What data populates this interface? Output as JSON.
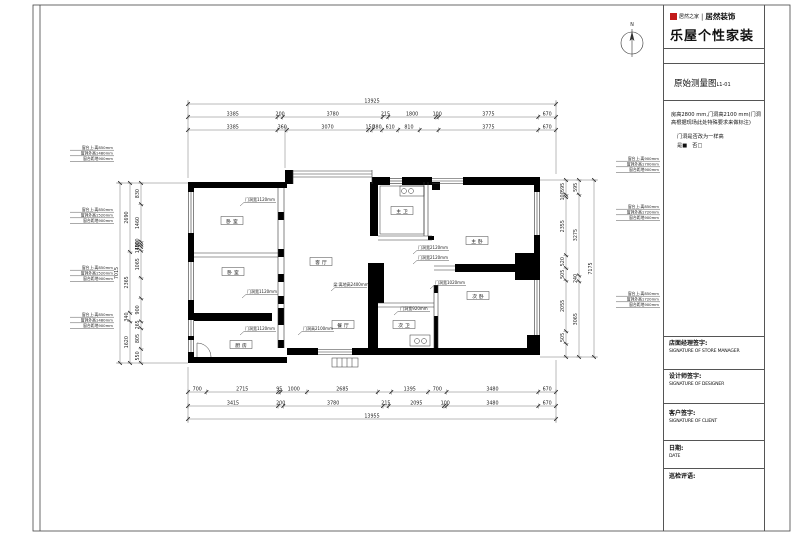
{
  "sheet": {
    "compass_label": "N"
  },
  "title_block": {
    "brand_small": "居然之家",
    "brand_divider": "|",
    "brand_bold": "居然装饰",
    "brand_main": "乐屋个性家装",
    "drawing_title": "原始测量图",
    "drawing_no": "L1-01",
    "note_line1": "房高2800 mm,门洞高2100 mm(门洞",
    "note_line2": "高根据现场此处特殊要求来做标注)",
    "question": "门洞是否改为一样高",
    "answer": "是■　否□",
    "sign_rows": [
      {
        "cn": "店面经理签字:",
        "en": "SIGNATURE OF STORE MANAGER"
      },
      {
        "cn": "设计师签字:",
        "en": "SIGNATURE OF DESIGNER"
      },
      {
        "cn": "客户签字:",
        "en": "SIGNATURE OF CLIENT"
      },
      {
        "cn": "日期:",
        "en": "DATE"
      },
      {
        "cn": "巡检评语:",
        "en": ""
      }
    ]
  },
  "rooms": [
    {
      "id": "bedroom-1",
      "label": "卧室"
    },
    {
      "id": "bedroom-2",
      "label": "卧室"
    },
    {
      "id": "kitchen",
      "label": "厨房"
    },
    {
      "id": "living-room",
      "label": "客厅"
    },
    {
      "id": "dining-room",
      "label": "餐厅"
    },
    {
      "id": "master-bath",
      "label": "主卫"
    },
    {
      "id": "master-bedroom",
      "label": "主卧"
    },
    {
      "id": "second-bedroom",
      "label": "次卧"
    },
    {
      "id": "second-bath",
      "label": "次卫"
    }
  ],
  "annotations": [
    {
      "id": "door-1",
      "text": "门洞宽1120mm"
    },
    {
      "id": "door-2",
      "text": "门洞宽1120mm"
    },
    {
      "id": "door-3",
      "text": "门洞宽1120mm"
    },
    {
      "id": "door-4",
      "text": "门洞宽2120mm"
    },
    {
      "id": "door-5",
      "text": "门洞宽2120mm"
    },
    {
      "id": "door-6",
      "text": "门洞宽1020mm"
    },
    {
      "id": "door-7",
      "text": "门洞宽920mm"
    },
    {
      "id": "beam",
      "text": "梁:离地高2400mm"
    },
    {
      "id": "door-height",
      "text": "门洞高2100mm"
    }
  ],
  "window_notes": {
    "left": [
      [
        "窗台上:离850mm",
        "窗洞外高1480mm",
        "窗台距地900mm"
      ],
      [
        "窗台上:离850mm",
        "窗洞外高1520mm",
        "窗台距地900mm"
      ],
      [
        "窗台上:离850mm",
        "窗洞外高1520mm",
        "窗台距地900mm"
      ],
      [
        "窗台上:离850mm",
        "窗洞外高1480mm",
        "窗台距地900mm"
      ]
    ],
    "right": [
      [
        "窗台上:离900mm",
        "窗洞外高1700mm",
        "窗台距地900mm"
      ],
      [
        "窗台上:离850mm",
        "窗洞外高1720mm",
        "窗台距地900mm"
      ],
      [
        "窗台上:离850mm",
        "窗洞外高1720mm",
        "窗台距地900mm"
      ]
    ]
  },
  "dims": {
    "top_total": [
      {
        "label": "13925",
        "mm": 13925
      }
    ],
    "top_row2": [
      {
        "label": "3385",
        "mm": 3385
      },
      {
        "label": "200",
        "mm": 200
      },
      {
        "label": "3780",
        "mm": 3780
      },
      {
        "label": "215",
        "mm": 215
      },
      {
        "label": "1800",
        "mm": 1800
      },
      {
        "label": "100",
        "mm": 100
      },
      {
        "label": "3775",
        "mm": 3775
      },
      {
        "label": "670",
        "mm": 670
      }
    ],
    "top_row3": [
      {
        "label": "3385",
        "mm": 3385
      },
      {
        "label": "360",
        "mm": 360
      },
      {
        "label": "3070",
        "mm": 3070
      },
      {
        "label": "150",
        "mm": 150
      },
      {
        "label": "380",
        "mm": 380
      },
      {
        "label": "610",
        "mm": 610
      },
      {
        "label": "810",
        "mm": 810
      },
      {
        "label": "",
        "mm": 715
      },
      {
        "label": "3775",
        "mm": 3775
      },
      {
        "label": "670",
        "mm": 670
      }
    ],
    "bottom_row1": [
      {
        "label": "700",
        "mm": 700
      },
      {
        "label": "2715",
        "mm": 2715
      },
      {
        "label": "95",
        "mm": 95
      },
      {
        "label": "1000",
        "mm": 1000
      },
      {
        "label": "2685",
        "mm": 2685
      },
      {
        "label": "",
        "mm": 515
      },
      {
        "label": "1395",
        "mm": 1395
      },
      {
        "label": "700",
        "mm": 700
      },
      {
        "label": "3480",
        "mm": 3480
      },
      {
        "label": "670",
        "mm": 670
      }
    ],
    "bottom_row2": [
      {
        "label": "3415",
        "mm": 3415
      },
      {
        "label": "200",
        "mm": 200
      },
      {
        "label": "3780",
        "mm": 3780
      },
      {
        "label": "215",
        "mm": 215
      },
      {
        "label": "2095",
        "mm": 2095
      },
      {
        "label": "100",
        "mm": 100
      },
      {
        "label": "3480",
        "mm": 3480
      },
      {
        "label": "670",
        "mm": 670
      }
    ],
    "bottom_total": [
      {
        "label": "13955",
        "mm": 13955
      }
    ],
    "left_outer": [
      {
        "label": "7015",
        "mm": 7015
      }
    ],
    "left_mid": [
      {
        "label": "2690",
        "mm": 2690
      },
      {
        "label": "2365",
        "mm": 2365
      },
      {
        "label": "340",
        "mm": 340
      },
      {
        "label": "1620",
        "mm": 1620
      }
    ],
    "left_inner": [
      {
        "label": "830",
        "mm": 830
      },
      {
        "label": "1460",
        "mm": 1460
      },
      {
        "label": "100",
        "mm": 100
      },
      {
        "label": "100",
        "mm": 100
      },
      {
        "label": "145",
        "mm": 145
      },
      {
        "label": "1065",
        "mm": 1065
      },
      {
        "label": "",
        "mm": 795
      },
      {
        "label": "900",
        "mm": 900
      },
      {
        "label": "265",
        "mm": 265
      },
      {
        "label": "805",
        "mm": 805
      },
      {
        "label": "550",
        "mm": 550
      }
    ],
    "right_inner": [
      {
        "label": "595",
        "mm": 595
      },
      {
        "label": "100",
        "mm": 100
      },
      {
        "label": "2355",
        "mm": 2355
      },
      {
        "label": "520",
        "mm": 520
      },
      {
        "label": "505",
        "mm": 505
      },
      {
        "label": "2055",
        "mm": 2055
      },
      {
        "label": "505",
        "mm": 505
      },
      {
        "label": "",
        "mm": 540
      }
    ],
    "right_mid": [
      {
        "label": "595",
        "mm": 595
      },
      {
        "label": "3275",
        "mm": 3275
      },
      {
        "label": "240",
        "mm": 240
      },
      {
        "label": "3065",
        "mm": 3065
      }
    ],
    "right_outer": [
      {
        "label": "7175",
        "mm": 7175
      }
    ]
  }
}
